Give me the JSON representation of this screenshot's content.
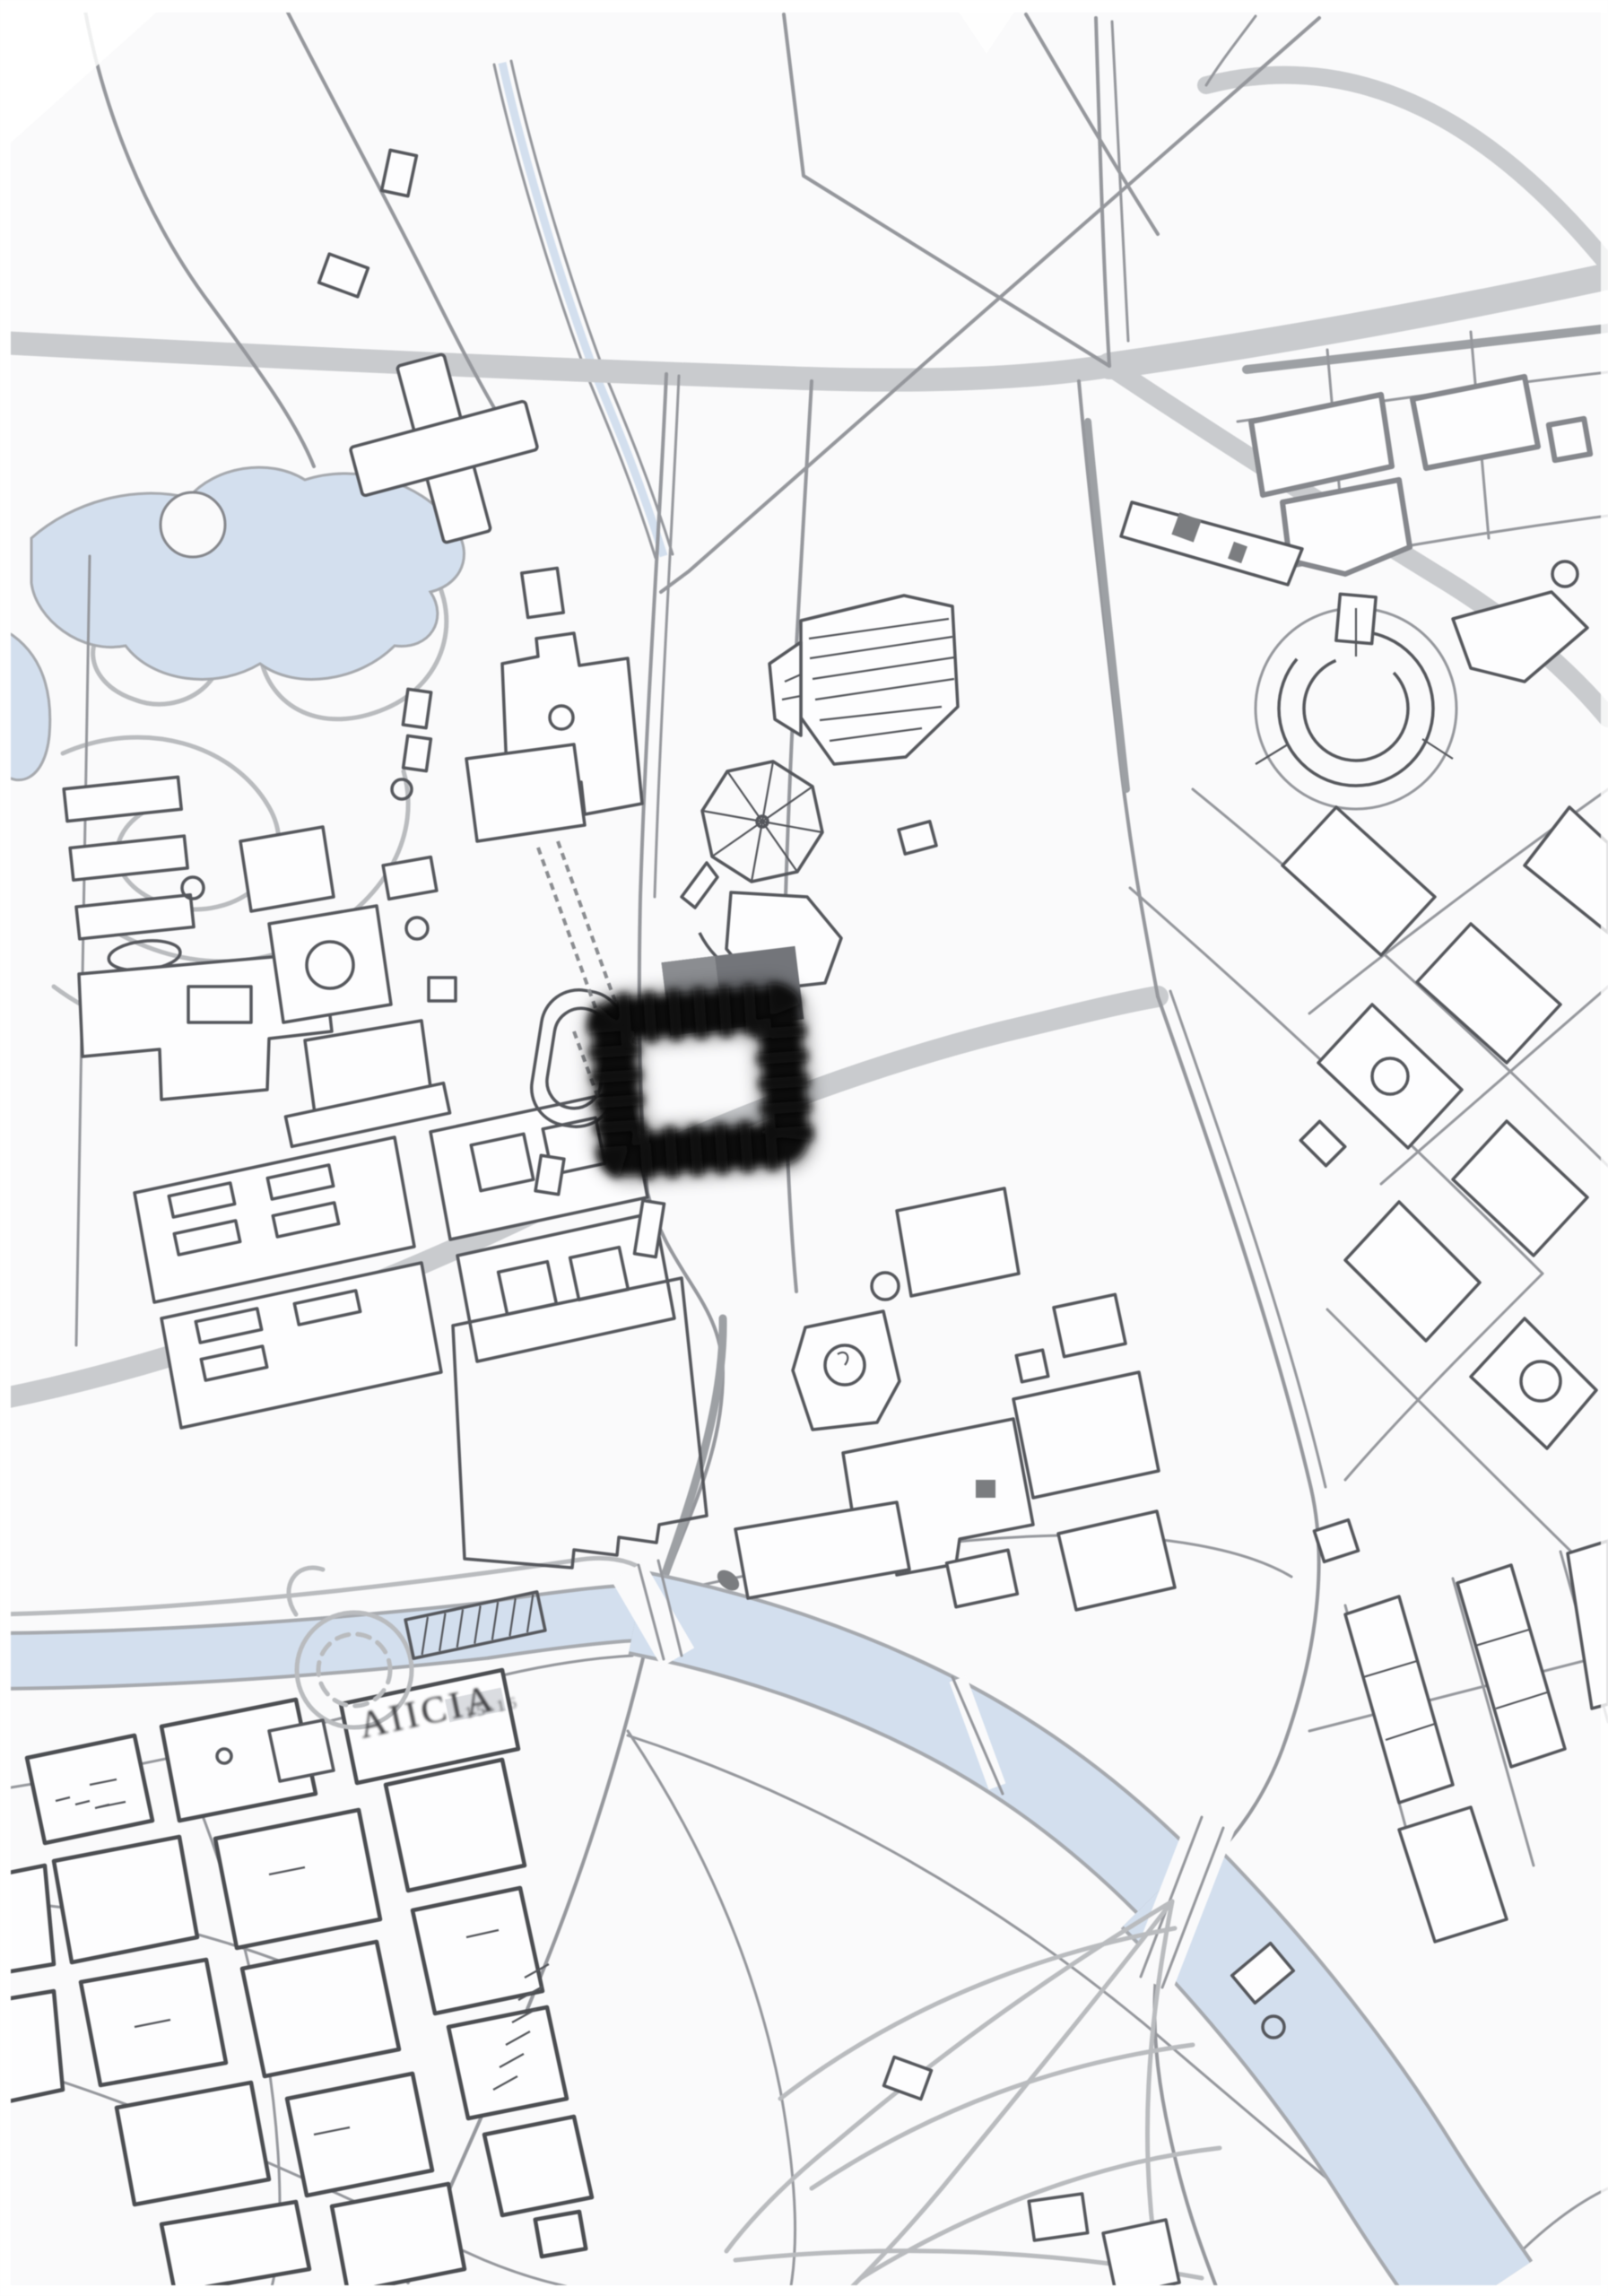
{
  "meta": {
    "title": "Monochrome city line map with a black square highlighting one building"
  },
  "colors": {
    "paper": "#fafafb",
    "ink": "#55575c",
    "ink_old": "#4b4d51",
    "ink_light": "#85878c",
    "road": "#95979c",
    "road_light": "#b9bbbe",
    "road_fill": "#c9cbce",
    "median": "#9da0a4",
    "water": "#d3dfee",
    "water_edge": "#a6a9ae",
    "marker": "#0b0b0b",
    "shadow_block": "#73757a",
    "shadow_block_light": "#8b8d91",
    "label_ink": "#3a3b3e",
    "detail_fill": "#7b7d80"
  },
  "map": {
    "river_label": "AIICIA",
    "river_sublabel": "15·16",
    "marker": {
      "label": "highlighted building",
      "shape": "square-ring",
      "color": "#0b0b0b"
    },
    "features": [
      {
        "id": "park-pond",
        "label": "Park pond"
      },
      {
        "id": "canal",
        "label": "Canal"
      },
      {
        "id": "cross-building",
        "label": "Cross-shaped building"
      },
      {
        "id": "rotunda-wheel",
        "label": "Radial rotunda"
      },
      {
        "id": "fan-hall",
        "label": "Fan-roofed hall"
      },
      {
        "id": "stadium-track",
        "label": "Oval track"
      },
      {
        "id": "circular-plaza",
        "label": "Circular plaza"
      },
      {
        "id": "highlighted-building-marker",
        "label": "Black square highlight"
      },
      {
        "id": "river",
        "label": "River"
      },
      {
        "id": "old-town",
        "label": "Old town blocks"
      },
      {
        "id": "garden-parterre",
        "label": "Garden parterre"
      },
      {
        "id": "fan-park",
        "label": "Radiating park paths"
      }
    ]
  }
}
